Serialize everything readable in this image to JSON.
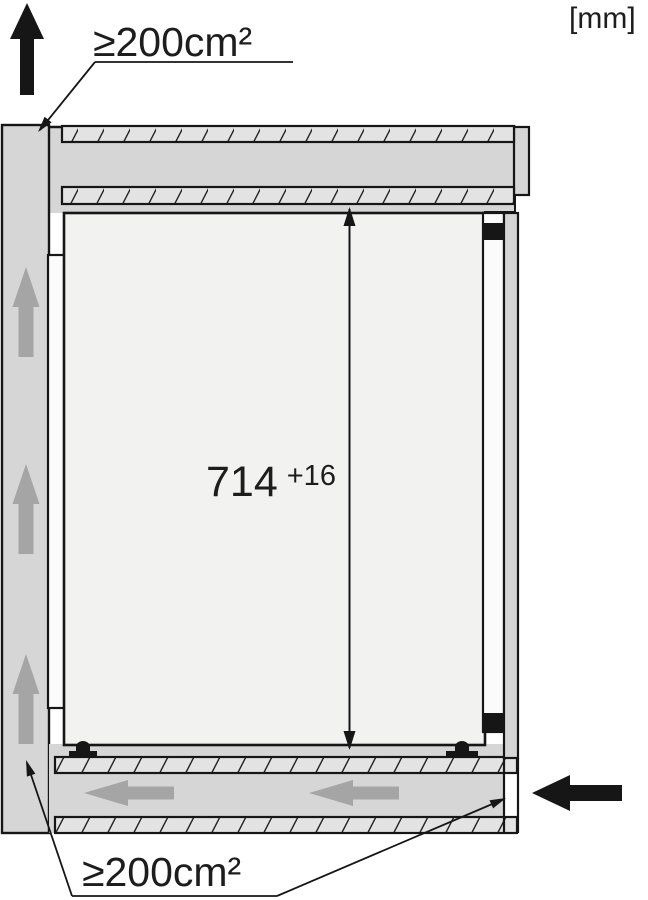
{
  "diagram": {
    "name": "built-in-appliance-ventilation-side-section",
    "units_label": "[mm]",
    "labels": {
      "vent_top": "≥200cm²",
      "vent_bottom": "≥200cm²"
    },
    "dimension": {
      "value": "714",
      "tolerance": "+16"
    },
    "icons": {
      "air_outlet": "arrow-up-black",
      "air_inlet": "arrow-left-black",
      "rear_channel_flow": "arrow-up-gray",
      "plinth_channel_flow": "arrow-left-gray"
    },
    "colors": {
      "outline": "#161616",
      "panel_fill": "#d6d6d6",
      "hatch_fill": "#e3e3e3",
      "appliance_fill": "#f2f2f1",
      "spacer_fill": "#fbfbfb",
      "airflow_arrow": "#a5a5a5",
      "background": "#ffffff"
    }
  }
}
